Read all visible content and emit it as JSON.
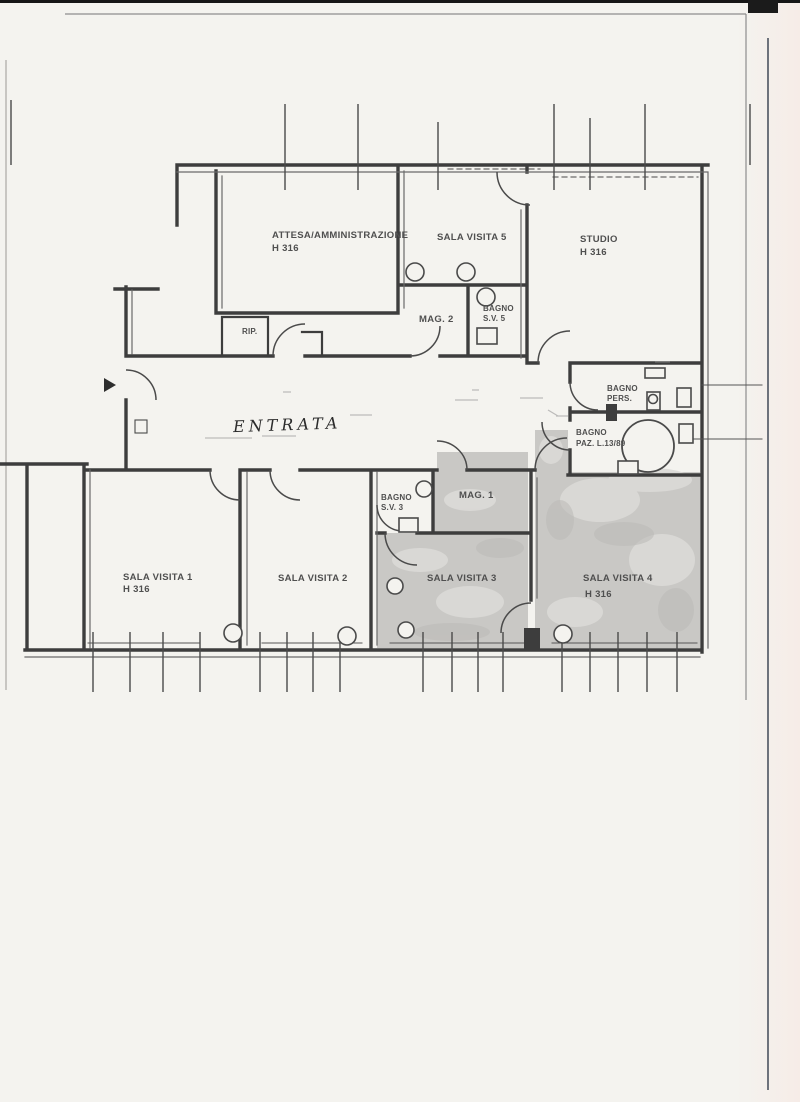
{
  "document": {
    "kind": "scanned architectural floor plan",
    "language": "Italian"
  },
  "colors": {
    "paper": "#f4f3ef",
    "wall": "#3d3d3d",
    "shaded_floor": "#c9c8c5",
    "label_text": "#4f4f4f",
    "scan_edge": "#161616"
  },
  "rooms": {
    "attesa": {
      "label": "ATTESA/AMMINISTRAZIONE",
      "height": "H 316"
    },
    "sala_visita_5": {
      "label": "SALA VISITA 5"
    },
    "studio": {
      "label": "STUDIO",
      "height": "H 316"
    },
    "mag_2": {
      "label": "MAG. 2"
    },
    "bagno_sv5": {
      "label": "BAGNO",
      "sub": "S.V. 5"
    },
    "rip": {
      "label": "RIP."
    },
    "entrata": {
      "label": "ENTRATA"
    },
    "bagno_pers": {
      "label": "BAGNO",
      "sub": "PERS."
    },
    "bagno_paz": {
      "label": "BAGNO",
      "sub": "PAZ. L.13/89"
    },
    "bagno_sv3": {
      "label": "BAGNO",
      "sub": "S.V. 3"
    },
    "mag_1": {
      "label": "MAG. 1"
    },
    "sala_visita_1": {
      "label": "SALA VISITA 1",
      "height": "H 316"
    },
    "sala_visita_2": {
      "label": "SALA VISITA 2"
    },
    "sala_visita_3": {
      "label": "SALA VISITA 3"
    },
    "sala_visita_4": {
      "label": "SALA VISITA 4",
      "height": "H 316"
    }
  }
}
